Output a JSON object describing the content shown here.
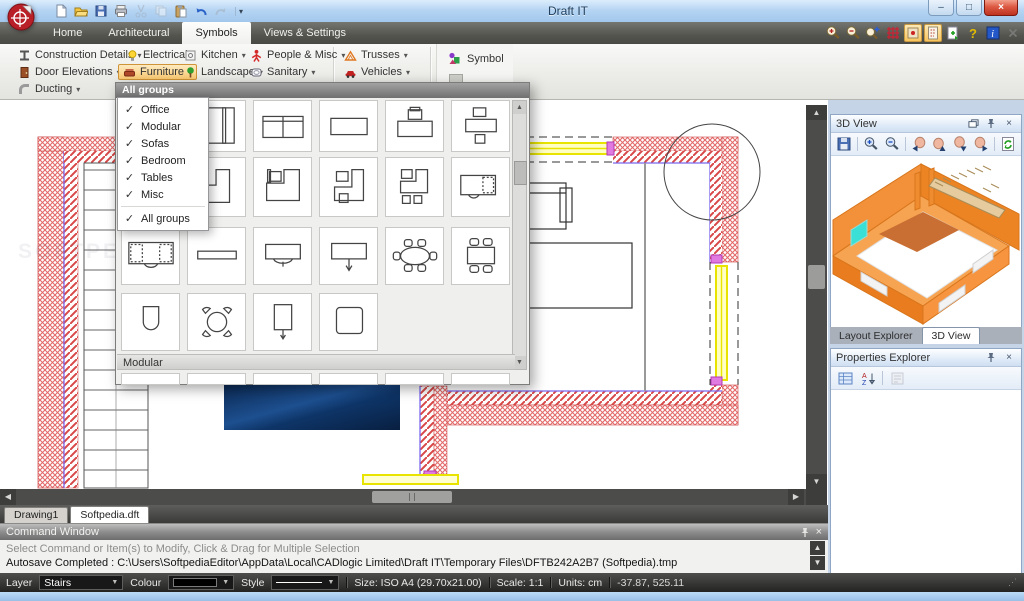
{
  "window": {
    "title": "Draft IT",
    "controls": {
      "minimize": "–",
      "maximize": "□",
      "close": "×"
    }
  },
  "qat": {
    "icons": [
      "new",
      "open",
      "save",
      "print",
      "cut",
      "copy",
      "paste",
      "undo",
      "redo"
    ],
    "more": "▾"
  },
  "ribbon_tabs": [
    {
      "label": "Home",
      "active": false
    },
    {
      "label": "Architectural",
      "active": false
    },
    {
      "label": "Symbols",
      "active": true
    },
    {
      "label": "Views & Settings",
      "active": false
    }
  ],
  "ribbon": {
    "buttons": [
      {
        "label": "Construction Details",
        "icon": "construction-details",
        "highlighted": false
      },
      {
        "label": "Electrical",
        "icon": "electrical",
        "highlighted": false
      },
      {
        "label": "Kitchen",
        "icon": "kitchen",
        "highlighted": false
      },
      {
        "label": "People & Misc",
        "icon": "people-misc",
        "highlighted": false
      },
      {
        "label": "Trusses",
        "icon": "trusses",
        "highlighted": false
      },
      {
        "label": "Door Elevations",
        "icon": "door-elevations",
        "highlighted": false
      },
      {
        "label": "Furniture",
        "icon": "furniture",
        "highlighted": true
      },
      {
        "label": "Landscape",
        "icon": "landscape",
        "highlighted": false
      },
      {
        "label": "Sanitary",
        "icon": "sanitary",
        "highlighted": false
      },
      {
        "label": "Vehicles",
        "icon": "vehicles",
        "highlighted": false
      },
      {
        "label": "Ducting",
        "icon": "ducting",
        "highlighted": false
      }
    ],
    "symbol_button": {
      "label": "Symbol",
      "icon": "symbol"
    },
    "window_icons": [
      "zoom-in",
      "zoom-out",
      "zoom-extents",
      "snap-grid",
      "snap-toggle",
      "ortho-toggle",
      "export-view",
      "help",
      "info",
      "close-ribbon"
    ]
  },
  "palette": {
    "header": "All groups",
    "section_label": "Modular",
    "rows": [
      [
        "sofa-large",
        "sofa-arm",
        "sofa-two-seat",
        "table-rect",
        "desk-chair",
        "desk-chair-stool"
      ],
      [
        "l-desk",
        "l-desk-2",
        "l-desk-chair",
        "desk-return-chair",
        "desk-chair-stools",
        "desk-dashed-chair"
      ],
      [
        "desk-dashed-arc",
        "shelf",
        "table-arc-chair",
        "table-arrow",
        "table-oval-seats",
        "table-rect-seats"
      ],
      [
        "toilet",
        "table-round-seats",
        "cabinet-arrow",
        "table-square"
      ]
    ],
    "menu": {
      "items": [
        {
          "label": "Office",
          "checked": true
        },
        {
          "label": "Modular",
          "checked": true
        },
        {
          "label": "Sofas",
          "checked": true
        },
        {
          "label": "Bedroom",
          "checked": true
        },
        {
          "label": "Tables",
          "checked": true
        },
        {
          "label": "Misc",
          "checked": true
        },
        {
          "label": "All groups",
          "checked": true,
          "separator_before": true
        }
      ]
    }
  },
  "panels": {
    "view3d_title": "3D View",
    "view3d_tools": [
      "save-view",
      "zoom-in-3d",
      "zoom-out-3d",
      "pan-left",
      "pan-up",
      "pan-down",
      "pan-right",
      "refresh-3d"
    ],
    "tabs": [
      {
        "label": "Layout Explorer",
        "active": false
      },
      {
        "label": "3D View",
        "active": true
      }
    ],
    "properties_title": "Properties Explorer",
    "properties_tools": [
      "categorized",
      "sort-az",
      "property-pages"
    ]
  },
  "doc_tabs": [
    {
      "label": "Drawing1",
      "active": false
    },
    {
      "label": "Softpedia.dft",
      "active": true
    }
  ],
  "command_window": {
    "title": "Command Window",
    "lines": [
      "Select Command or Item(s) to Modify, Click & Drag for Multiple Selection",
      "Autosave Completed : C:\\Users\\SoftpediaEditor\\AppData\\Local\\CADlogic Limited\\Draft IT\\Temporary Files\\DFTB242A2B7 (Softpedia).tmp"
    ]
  },
  "status_bar": {
    "layer_label": "Layer",
    "layer_value": "Stairs",
    "colour_label": "Colour",
    "style_label": "Style",
    "size": "Size: ISO A4 (29.70x21.00)",
    "scale": "Scale: 1:1",
    "units": "Units: cm",
    "coords": "-37.87, 525.11"
  },
  "watermark": "SOFTPEDIA",
  "colors": {
    "highlight_orange": "#fbca72",
    "wall_hatch_red": "#e05a5a",
    "window_yellow": "#f2ef00",
    "model_orange": "#f08a2e",
    "close_red": "#dd5a43",
    "selection_blue": "#2458c8"
  }
}
